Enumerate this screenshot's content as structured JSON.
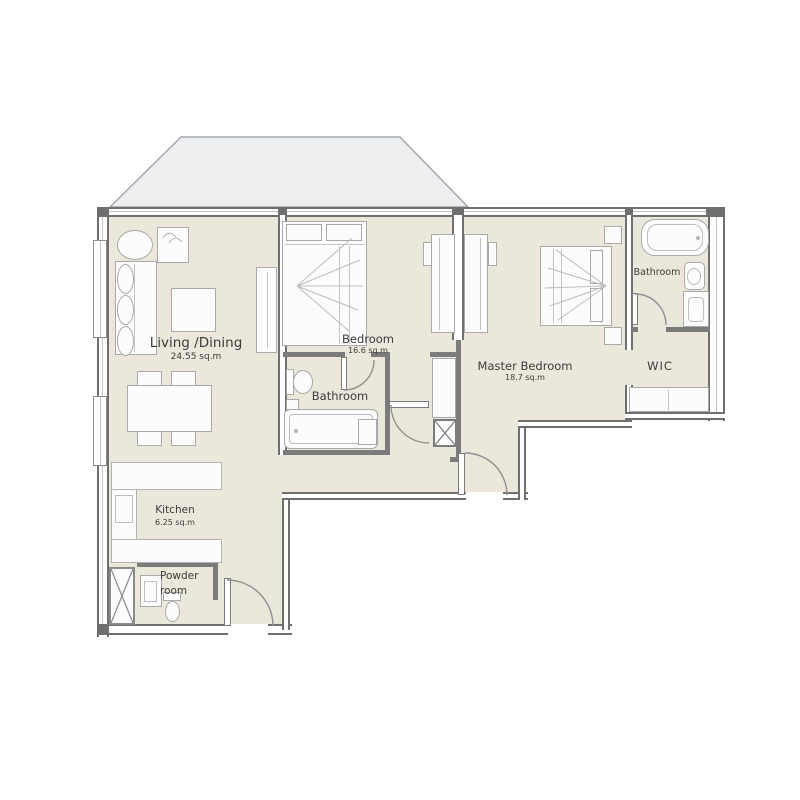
{
  "plan_title": "Apartment floor plan",
  "rooms": {
    "living": {
      "name": "Living /Dining",
      "area": "24.55 sq.m"
    },
    "bedroom": {
      "name": "Bedroom",
      "area": "16.6 sq.m"
    },
    "master": {
      "name": "Master Bedroom",
      "area": "18.7 sq.m"
    },
    "bathroom2": {
      "name": "Bathroom"
    },
    "bathroom1": {
      "name": "Bathroom"
    },
    "wic": {
      "name": "WIC"
    },
    "kitchen": {
      "name": "Kitchen",
      "area": "6.25 sq.m"
    },
    "powder": {
      "name_line1": "Powder",
      "name_line2": "room"
    }
  },
  "colors": {
    "floor": "#ece7db",
    "terrace": "#eceef0",
    "wall": "#6f6f6f",
    "partition": "#7b7b7b",
    "furniture_fill": "#fcfcfc",
    "furniture_border": "#a9a9a9",
    "text": "#3b3b3b"
  }
}
